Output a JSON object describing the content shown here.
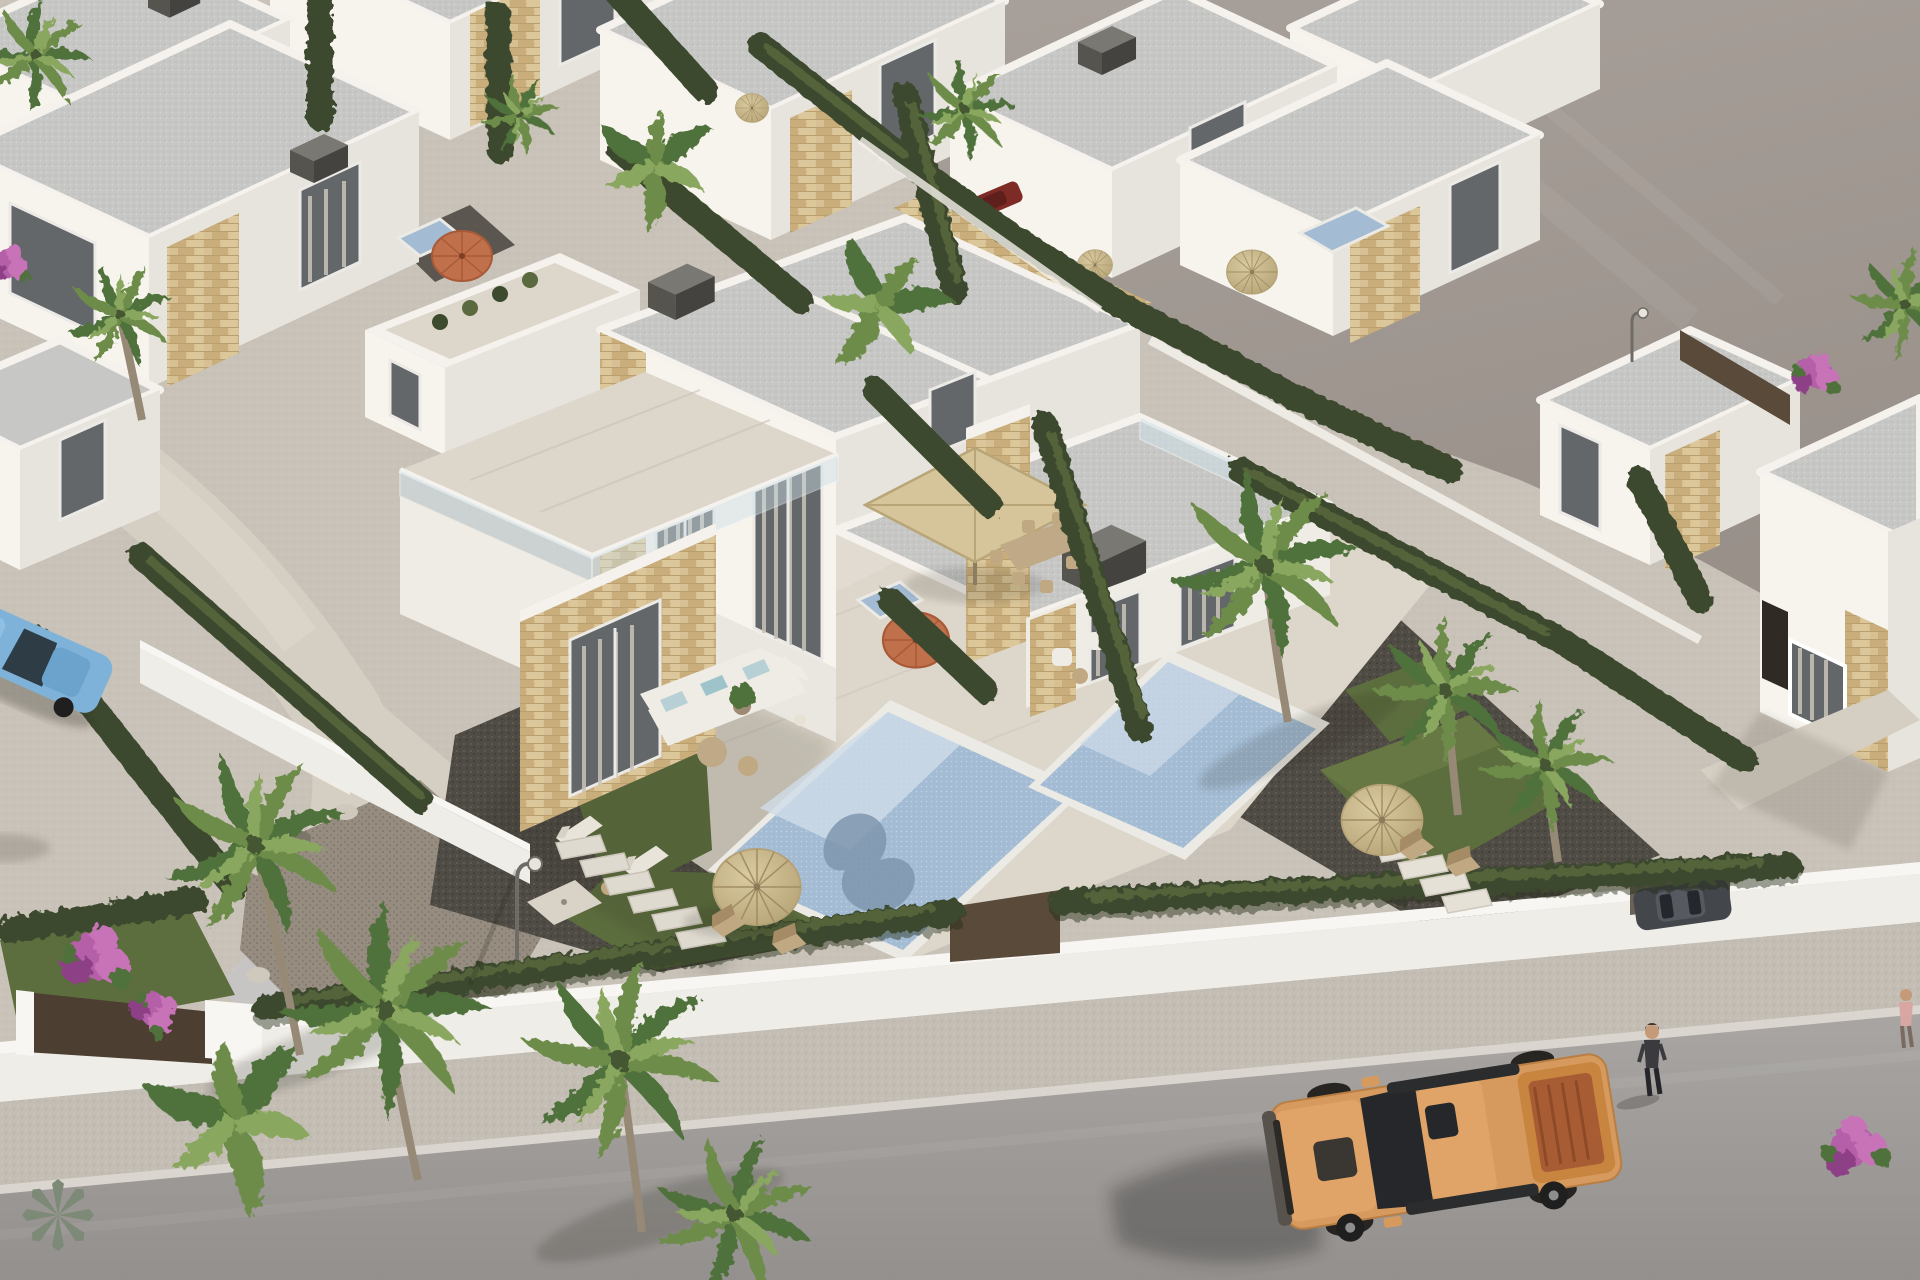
{
  "scene": {
    "type": "3d-architectural-aerial-render",
    "subject": "modern white villa development with private pools beside a street",
    "time_of_day": "daylight",
    "visible_text": [],
    "objects": {
      "buildings": [
        {
          "name": "central-duplex-villa",
          "features": [
            "flat gray roof",
            "white walls",
            "stone cladding piers",
            "tall curtained windows",
            "roof terrace with glass balustrade",
            "terrace with outdoor lounge"
          ]
        },
        {
          "name": "background-villas",
          "count": 8,
          "features": [
            "flat roofs",
            "white parapets",
            "stone accents",
            "dark chimney boxes"
          ]
        },
        {
          "name": "right-villa",
          "features": [
            "stone clad facade",
            "white framed window"
          ]
        },
        {
          "name": "far-right-villa",
          "features": [
            "partially cropped",
            "dark doorway"
          ]
        }
      ],
      "pools": [
        {
          "name": "pool-left",
          "water": "light blue mosaic with shadow patterns"
        },
        {
          "name": "pool-right",
          "water": "light blue mosaic"
        },
        {
          "name": "plunge-pools",
          "count": 3
        }
      ],
      "vegetation": {
        "palm-trees": 12,
        "banana-plants": 3,
        "cypress-hedges": "many rows",
        "bougainvillea-clusters": 4,
        "lawn-patches": 5,
        "agave": 1
      },
      "street": {
        "road": "gray asphalt",
        "sidewalk": "light speckled concrete",
        "perimeter-wall": "low white wall with hedge on top",
        "gate": "dark brown entrance gate"
      },
      "props": [
        "straw parasols",
        "orange parasols",
        "beige square pergola parasol",
        "white L-shaped sofa with light blue cushions",
        "wooden deck chairs",
        "sun loungers",
        "dining set",
        "stepping stones",
        "street lamps",
        "outdoor shower pad",
        "rock garden"
      ],
      "vehicles": [
        {
          "name": "orange-pickup-truck",
          "location": "driving on road, bottom right"
        },
        {
          "name": "blue-sedan",
          "location": "parked, left edge"
        },
        {
          "name": "dark-gray-car",
          "location": "driveway behind right hedge"
        },
        {
          "name": "dark-red-car",
          "location": "behind hedge, upper middle"
        },
        {
          "name": "gray-car",
          "location": "on bare lot track, top middle"
        }
      ],
      "people": [
        {
          "name": "pedestrian-dark-jacket",
          "location": "sidewalk bottom right, walking"
        },
        {
          "name": "pedestrian-pink-top",
          "location": "right edge, partially cropped"
        }
      ],
      "terrain": {
        "bare-lot": "empty gray graded land, upper right",
        "gravel-yards": "dark gravel",
        "walkways": "light concrete"
      }
    }
  },
  "palette": {
    "lot1": "#a9a19b",
    "lot2": "#989089",
    "dev": "#c9c2b8",
    "devDot": "#8d887f",
    "roadTop": "#a9a5a3",
    "roadBot": "#93908d",
    "sidewalk": "#c3bdb4",
    "curb": "#dad5ce",
    "wallFace": "#efede8",
    "wallTopC": "#f8f6f2",
    "gateBrown": "#4c3e31",
    "fenceBrown": "#5a4a3a",
    "walkway": "#d5cec3",
    "pathBlue": "#c6c5c3",
    "gravel": "#4f4b45",
    "gravelLight": "#6a6257",
    "gravelDark": "#2f2c28",
    "pebble": "#968d80",
    "rockLight": "#cfc8bc",
    "rockDark": "#7c756a",
    "lawn": "#5d6e3e",
    "lawnLight": "#71824a",
    "lawnShade": "#47572f",
    "hedge": "#3c4a2d",
    "hedgeLight": "#5a6a3e",
    "hedgeShadow": "#252e1c",
    "palm1": "#6d8c4a",
    "palm2": "#50713a",
    "palm3": "#8aa75e",
    "palmCore": "#445630",
    "trunk": "#968a77",
    "trunkShadow": "#6f6557",
    "boug1": "#b45fa8",
    "boug2": "#c873b8",
    "boug3": "#8e3f86",
    "agave": "#7e8a78",
    "wallLit": "#f7f4ee",
    "wallMid": "#efece5",
    "wallShaded": "#e7e3dd",
    "wallDark": "#d9d5cf",
    "roofGray": "#c7c8c6",
    "roofDot": "#9fa19f",
    "parapet": "#f5f2ed",
    "stone1": "#d7c194",
    "stone2": "#c9ae7c",
    "stone3": "#dcc79b",
    "stoneLine": "#b99f6e",
    "glassDark": "#63676a",
    "frame": "#eceae6",
    "curtain": "#cac4ba",
    "glassRail": "#cfe0e6",
    "tile": "#ddd6ca",
    "tileLine": "#c8c1b5",
    "poolBase": "#a3bcd4",
    "poolLight": "#cfdce8",
    "poolShadow": "#7e97ae",
    "poolDot": "#d7e4ee",
    "coping": "#eceae4",
    "straw1": "#d9caa0",
    "straw2": "#b3a173",
    "strawRib": "#a28d64",
    "strawEdge": "#b5a277",
    "orange1": "#c0714b",
    "orange2": "#a85a38",
    "canopy": "#d6c49a",
    "canopyRib": "#b9a678",
    "pole": "#8d7d5f",
    "sofa": "#efece6",
    "cushion": "#b7d0d6",
    "wood": "#c0a982",
    "tableTan": "#bfa987",
    "chimTop": "#7a7872",
    "chimFront": "#56544f",
    "chimSide": "#454340",
    "truckBody": "#d79a5e",
    "truckHood": "#e0a368",
    "truckDark": "#3a3632",
    "truckBed": "#a85c33",
    "truckBedWall": "#c8853f",
    "truckGlass": "#26272a",
    "wheel": "#1f1f1f",
    "hub": "#8e8e8e",
    "bumper": "#57524c",
    "carBlue": "#7fb2d8",
    "carBlueRoof": "#6ca3cd",
    "carGlass": "#2e3c46",
    "carGray": "#43464b",
    "carRed": "#7e2b26",
    "skin": "#c59a79",
    "jacket": "#3b3b3f",
    "pants": "#26262a",
    "hair": "#4a3526",
    "pink": "#d8a7a2",
    "shadow": "#26251f",
    "lampMetal": "#6f6c68",
    "lampHead": "#e8e4dc"
  }
}
